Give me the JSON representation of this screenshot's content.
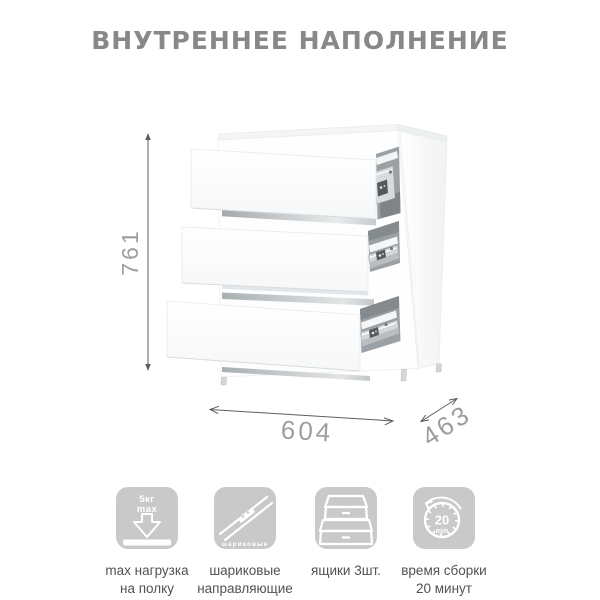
{
  "title": "ВНУТРЕННЕЕ НАПОЛНЕНИЕ",
  "diagram": {
    "type": "furniture-dimension-diagram",
    "subject": "Белый комод с тремя выдвинутыми ящиками на шариковых направляющих",
    "dimensions": {
      "height": "761",
      "width": "604",
      "depth": "463"
    },
    "drawer_count": 3
  },
  "features": [
    {
      "name": "max-load-per-shelf",
      "badge": {
        "line1": "5кг",
        "line2": "max"
      },
      "label": [
        "max нагрузка",
        "на полку"
      ]
    },
    {
      "name": "ball-bearing-guides",
      "badge": {
        "caption": "шариковые"
      },
      "label": [
        "шариковые",
        "направляющие"
      ]
    },
    {
      "name": "drawers-count",
      "badge": {},
      "label": [
        "ящики 3шт."
      ]
    },
    {
      "name": "assembly-time",
      "badge": {
        "value": "20",
        "unit": "min"
      },
      "label": [
        "время сборки",
        "20 минут"
      ]
    }
  ],
  "colors": {
    "background": "#ffffff",
    "title_text": "#888889",
    "dimension_text": "#9c9ea1",
    "dimension_line": "#5b5c5e",
    "icon_tile": "#c9c9c9",
    "icon_glyph": "#ffffff",
    "label_text": "#4f5255",
    "cabinet_outline": "#e6e9ea",
    "slide_metal": "#d3d7da"
  }
}
